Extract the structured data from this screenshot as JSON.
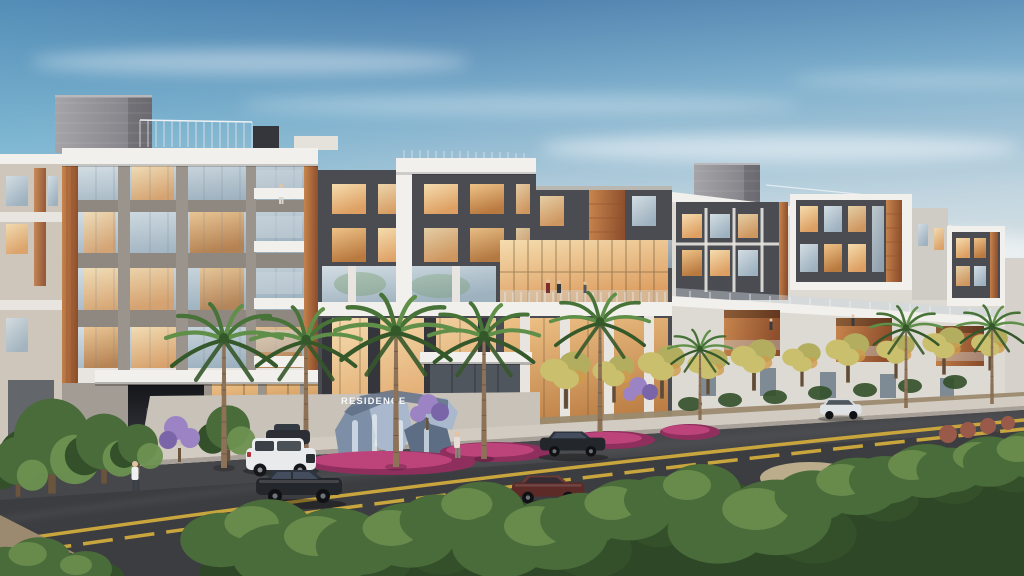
{
  "scene": {
    "type": "architectural-rendering",
    "alt": "Dusk rendering of a modern five-story mixed-use residence building with white and charcoal facades, wood accent panels, glowing windows, palm trees, landscaped parkway, a RESIDENCE rock sign with waterfall at the entry, cars on the street and pedestrians on the sidewalk.",
    "sign": {
      "text": "RESIDENCE"
    },
    "counts": {
      "floors": 5,
      "palm_trees": 8,
      "cars": 6,
      "people": 5
    },
    "colors": {
      "skyTop": "#3f72a5",
      "skyMid": "#7fb0cd",
      "skyLow": "#c3d6e0",
      "skyHorizon": "#e7ebe9",
      "cloud": "#ffffff",
      "white": "#f2f0ec",
      "whiteBand": "#e8e5e0",
      "concrete": "#8f8880",
      "concreteLight": "#9b948d",
      "charcoal": "#4b4c52",
      "charcoalDark": "#35363c",
      "wood": "#b26a3e",
      "woodDark": "#8e4f2c",
      "woodLight": "#c8854e",
      "glassCoolA": "#d3dde3",
      "glassCoolB": "#9db1bf",
      "glassWarmA": "#f5dcae",
      "glassWarmB": "#dd9f62",
      "glassDeepA": "#eec287",
      "glassDeepB": "#b97a40",
      "glassDark": "#50565e",
      "brick": "#97969b",
      "brickLight": "#a5a4a8",
      "brickDark": "#7c7b82",
      "sidewalk": "#d2cbc2",
      "driveway": "#c9c2b8",
      "road": "#3c3d40",
      "roadLight": "#4a4b4f",
      "laneYellow": "#c9a53d",
      "dirt": "#9b8a6f",
      "bushDark": "#33502a",
      "bushMid": "#4a6b3a",
      "bushLight": "#6d9150",
      "leafYellow": "#c9bf6c",
      "leafYellowDark": "#b3ad5f",
      "leafOrange": "#cf9a4e",
      "palmGreen": "#477238",
      "palmLight": "#5f8f48",
      "palmDark": "#35582b",
      "trunk": "#8d7258",
      "trunkDark": "#6b543e",
      "flowerMagenta": "#c2477e",
      "flowerMagentaDark": "#8e2f5d",
      "flowerPurple": "#9b83c4",
      "rockBlue": "#7d8fa6",
      "rockLight": "#a9b8cc",
      "rockDark": "#5d6d84",
      "carBlack": "#23262b",
      "carMaroon": "#5c2b28",
      "carWhite": "#e9eaec",
      "skin": "#e2c3a3",
      "shirtWhite": "#eef0f2"
    }
  }
}
